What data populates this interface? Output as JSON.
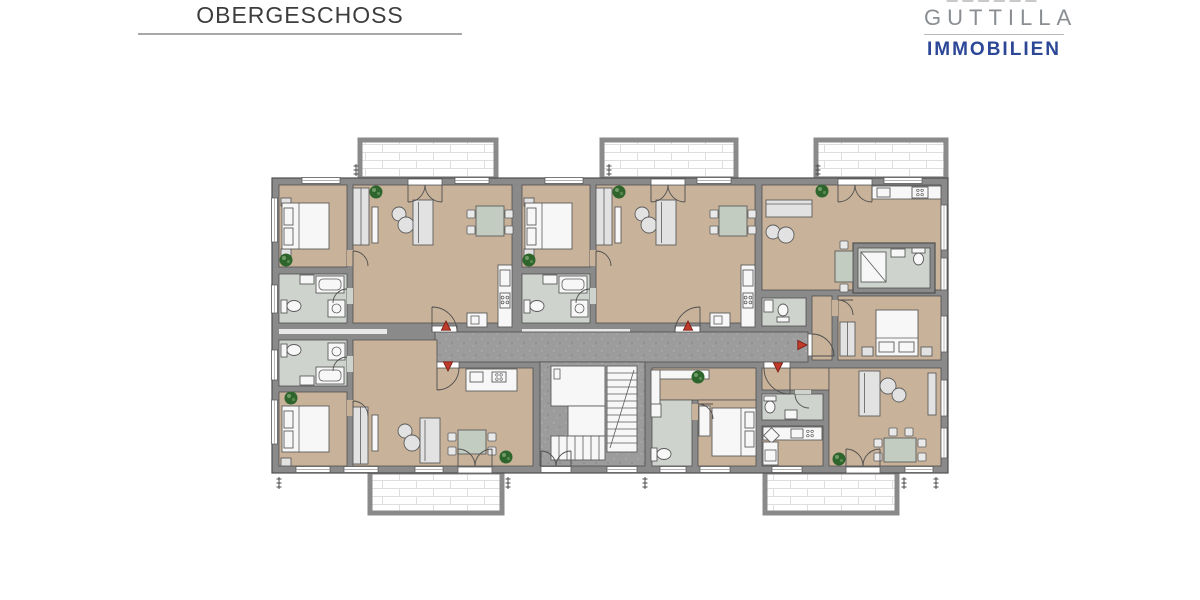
{
  "header": {
    "title": "OBERGESCHOSS"
  },
  "logo": {
    "name": "GUTTILLA",
    "tagline": "IMMOBILIEN"
  },
  "colors": {
    "title_gray": "#3d3d3d",
    "rule_gray": "#a8a8a8",
    "logo_gray": "#8a8e92",
    "logo_blue": "#2c4796",
    "floor_tan": "#c8b29a",
    "floor_bath": "#ced3cd",
    "corridor_gray": "#9c9c9c",
    "wall_gray": "#8a8a8a",
    "wall_outline": "#4f4f4f",
    "furniture_gray": "#e2e2e2",
    "fixture_white": "#f7f7f7",
    "table_green": "#c2ccc0",
    "plant_green": "#2e652c",
    "entry_arrow_red": "#bf3a2b",
    "brick_line": "#dedede",
    "balcony_white": "#ffffff"
  },
  "icons": {
    "plant": "plant-icon",
    "entry_arrow": "entry-arrow-icon",
    "dimension_tick": "dimension-tick-icon"
  }
}
